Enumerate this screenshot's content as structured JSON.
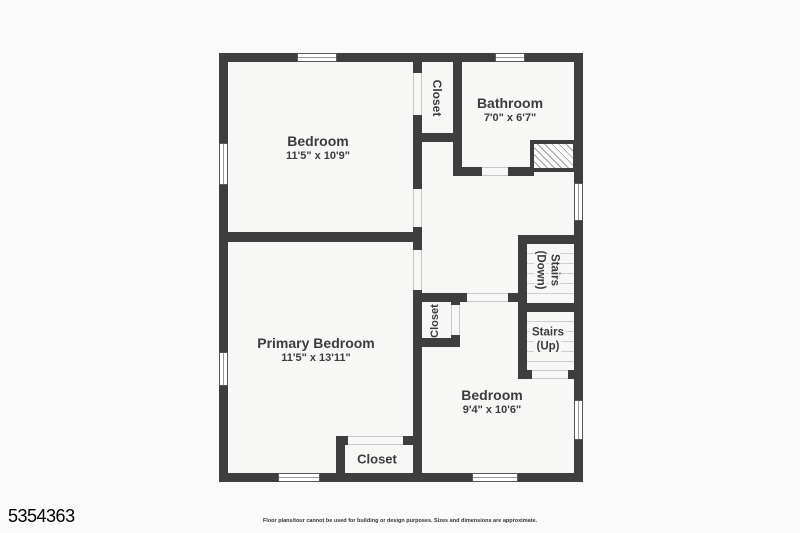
{
  "colors": {
    "wall": "#3e3e3e",
    "floor": "#f7f7f6",
    "background": "#fafafa",
    "text": "#3c3c3c",
    "stair_tread": "#cfcfcf"
  },
  "rooms": {
    "bedroom_top": {
      "name": "Bedroom",
      "dims": "11'5\" x 10'9\""
    },
    "closet_top": {
      "name": "Closet"
    },
    "bathroom": {
      "name": "Bathroom",
      "dims": "7'0\" x 6'7\""
    },
    "primary_bedroom": {
      "name": "Primary Bedroom",
      "dims": "11'5\" x 13'11\""
    },
    "closet_mid": {
      "name": "Closet"
    },
    "stairs_down": {
      "line1": "Stairs",
      "line2": "(Down)"
    },
    "stairs_up": {
      "line1": "Stairs",
      "line2": "(Up)"
    },
    "bedroom_bottom": {
      "name": "Bedroom",
      "dims": "9'4\" x 10'6\""
    },
    "closet_bottom": {
      "name": "Closet"
    }
  },
  "footer": {
    "mls_number": "5354363",
    "disclaimer": "Floor plans/tour cannot be used for building or design purposes. Sizes and dimensions are approximate."
  }
}
